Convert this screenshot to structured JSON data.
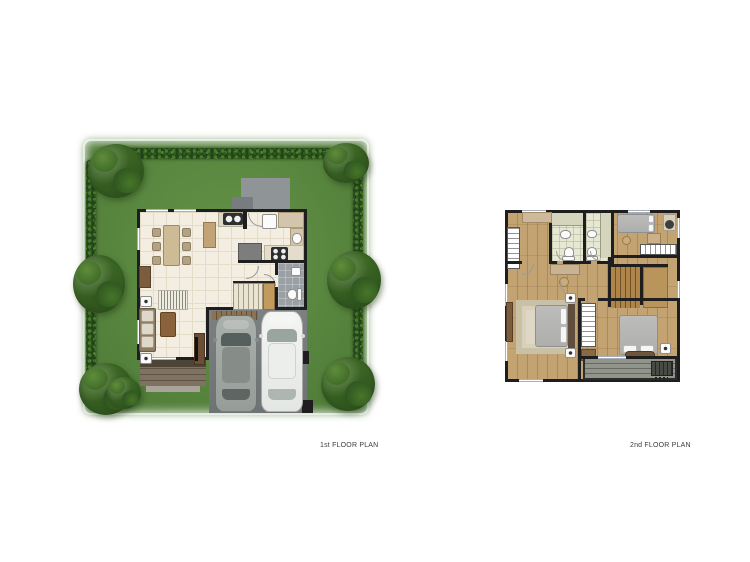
{
  "sheet": {
    "background": "#ffffff"
  },
  "plans": [
    {
      "id": "first-floor",
      "label": "1st FLOOR PLAN",
      "elements": [
        "garden lawn",
        "perimeter hedge",
        "corner trees and shrubs",
        "concrete entry pad",
        "entry step",
        "dining table with six chairs",
        "dining sideboard",
        "pantry cabinet",
        "kitchen sink counter",
        "refrigerator",
        "kitchen rear counter",
        "four-burner cooktop",
        "pantry island",
        "staircase",
        "toilet room with wc and basin",
        "living room rug",
        "sofa with three cushions",
        "side tables",
        "coffee table",
        "tv cabinet",
        "wood terrace deck",
        "carport slat mat",
        "driveway",
        "silver car",
        "white car",
        "gate posts"
      ]
    },
    {
      "id": "second-floor",
      "label": "2nd FLOOR PLAN",
      "elements": [
        "hall wardrobe",
        "hall dresser",
        "vanity counter with stool",
        "bathroom 1 with shower, basin and wc",
        "bathroom 2 with shower, basin and wc",
        "bedroom 2 bed",
        "bedroom 2 desk and chair",
        "bedroom 2 side table",
        "bedroom 2 dresser",
        "built-in wardrobe",
        "staircase",
        "master bedroom rug",
        "master bed with headboard",
        "nightstands",
        "master tv console",
        "walk-in closet",
        "closet bench",
        "bedroom 3 bed",
        "foot bench",
        "bedroom 3 dresser",
        "balcony deck",
        "air-condenser unit"
      ]
    }
  ],
  "palette": {
    "lawn_green": "#5a8840",
    "hedge_green": "#23431a",
    "tree_green": "#3a6423",
    "wall": "#1e1e1e",
    "tile_floor": "#f3eee1",
    "wood_floor": "#c4a372",
    "bath_tile": "#e7e8d4",
    "wc_tile": "#9aa0a3",
    "driveway": "#75797c",
    "entry_pad": "#8f9496",
    "terrace_wood": "#7f7261",
    "stair_wood": "#b0854a",
    "balcony_deck": "#90948a",
    "car_silver": "#a0a6a2",
    "car_white": "#f1f2f0",
    "bed_gray": "#b6b6b4",
    "rug_cream": "#dfd8c6",
    "label_text": "#3c3c3c"
  }
}
